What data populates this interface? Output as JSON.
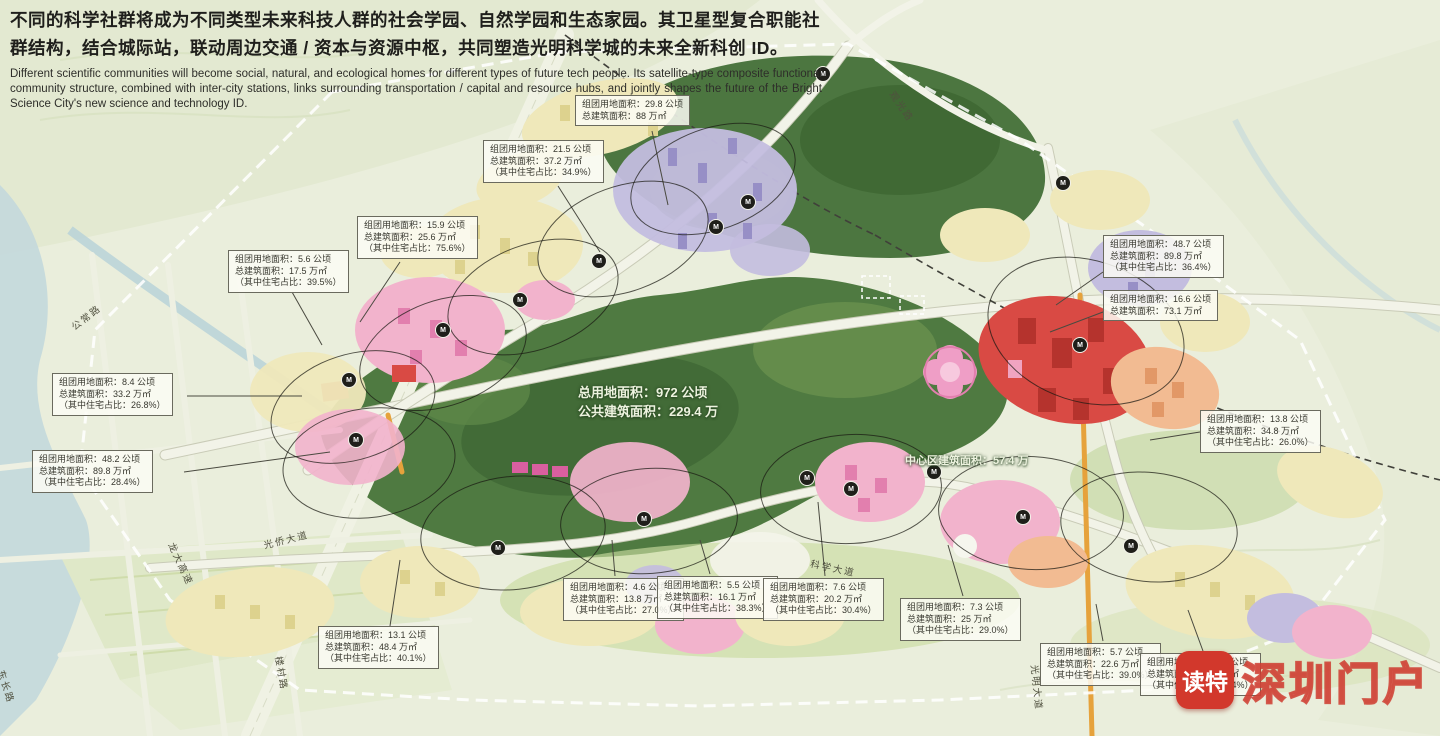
{
  "header": {
    "zh": "不同的科学社群将成为不同类型未来科技人群的社会学园、自然学园和生态家园。其卫星型复合职能社群结构，结合城际站，联动周边交通 / 资本与资源中枢，共同塑造光明科学城的未来全新科创 ID。",
    "en": "Different scientific communities will become social, natural, and ecological homes for different types of future tech people. Its satellite-type composite functional community structure, combined with inter-city stations, links surrounding transportation / capital and resource hubs, and jointly shapes the future of the Bright Science City's new science and technology ID."
  },
  "map": {
    "station_label": "M",
    "callouts": [
      {
        "lines": [
          "组团用地面积：29.8 公顷",
          "总建筑面积：88 万㎡",
          ""
        ]
      },
      {
        "lines": [
          "组团用地面积：21.5 公顷",
          "总建筑面积：37.2 万㎡",
          "（其中住宅占比：34.9%）"
        ]
      },
      {
        "lines": [
          "组团用地面积：15.9 公顷",
          "总建筑面积：25.6 万㎡",
          "（其中住宅占比：75.6%）"
        ]
      },
      {
        "lines": [
          "组团用地面积：5.6 公顷",
          "总建筑面积：17.5 万㎡",
          "（其中住宅占比：39.5%）"
        ]
      },
      {
        "lines": [
          "组团用地面积：8.4 公顷",
          "总建筑面积：33.2 万㎡",
          "（其中住宅占比：26.8%）"
        ]
      },
      {
        "lines": [
          "组团用地面积：48.2 公顷",
          "总建筑面积：89.8 万㎡",
          "（其中住宅占比：28.4%）"
        ]
      },
      {
        "lines": [
          "组团用地面积：13.1 公顷",
          "总建筑面积：48.4 万㎡",
          "（其中住宅占比：40.1%）"
        ]
      },
      {
        "lines": [
          "组团用地面积：4.6 公顷",
          "总建筑面积：13.8 万㎡",
          "（其中住宅占比：27.0%）"
        ]
      },
      {
        "lines": [
          "组团用地面积：5.5 公顷",
          "总建筑面积：16.1 万㎡",
          "（其中住宅占比：38.3%）"
        ]
      },
      {
        "lines": [
          "组团用地面积：7.6 公顷",
          "总建筑面积：20.2 万㎡",
          "（其中住宅占比：30.4%）"
        ]
      },
      {
        "lines": [
          "组团用地面积：7.3 公顷",
          "总建筑面积：25 万㎡",
          "（其中住宅占比：29.0%）"
        ]
      },
      {
        "lines": [
          "组团用地面积：5.7 公顷",
          "总建筑面积：22.6 万㎡",
          "（其中住宅占比：39.0%）"
        ]
      },
      {
        "lines": [
          "组团用地面积：16.2 公顷",
          "总建筑面积：29.2 万㎡",
          "（其中住宅占比：39.4%）"
        ]
      },
      {
        "lines": [
          "组团用地面积：48.7 公顷",
          "总建筑面积：89.8 万㎡",
          "（其中住宅占比：36.4%）"
        ]
      },
      {
        "lines": [
          "组团用地面积：16.6 公顷",
          "总建筑面积：73.1 万㎡",
          ""
        ]
      },
      {
        "lines": [
          "组团用地面积：13.8 公顷",
          "总建筑面积：34.8 万㎡",
          "（其中住宅占比：26.0%）"
        ]
      }
    ],
    "center_labels": {
      "total_line1": "总用地面积：972 公顷",
      "total_line2": "公共建筑面积：229.4 万",
      "core": "中心区建筑面积：57.4 万"
    },
    "road_labels": {
      "gongchang": "公常路",
      "longda": "龙大高速",
      "guangqiao": "光侨大道",
      "loucun": "楼村路",
      "dongchang": "东长路",
      "kexue": "科学大道",
      "guangming": "光明大道",
      "guanguang": "观光路"
    }
  },
  "watermark": {
    "badge": "读特",
    "text": "深圳门户"
  },
  "colors": {
    "forest_green": "#4d7840",
    "cluster_cream": "#efe8ba",
    "cluster_purple": "#c0badf",
    "cluster_pink": "#f2b3cc",
    "cluster_red": "#d94a44",
    "cluster_salmon": "#f2bb92",
    "road_orange": "#e6a23c",
    "watermark_red": "#d2382c"
  }
}
